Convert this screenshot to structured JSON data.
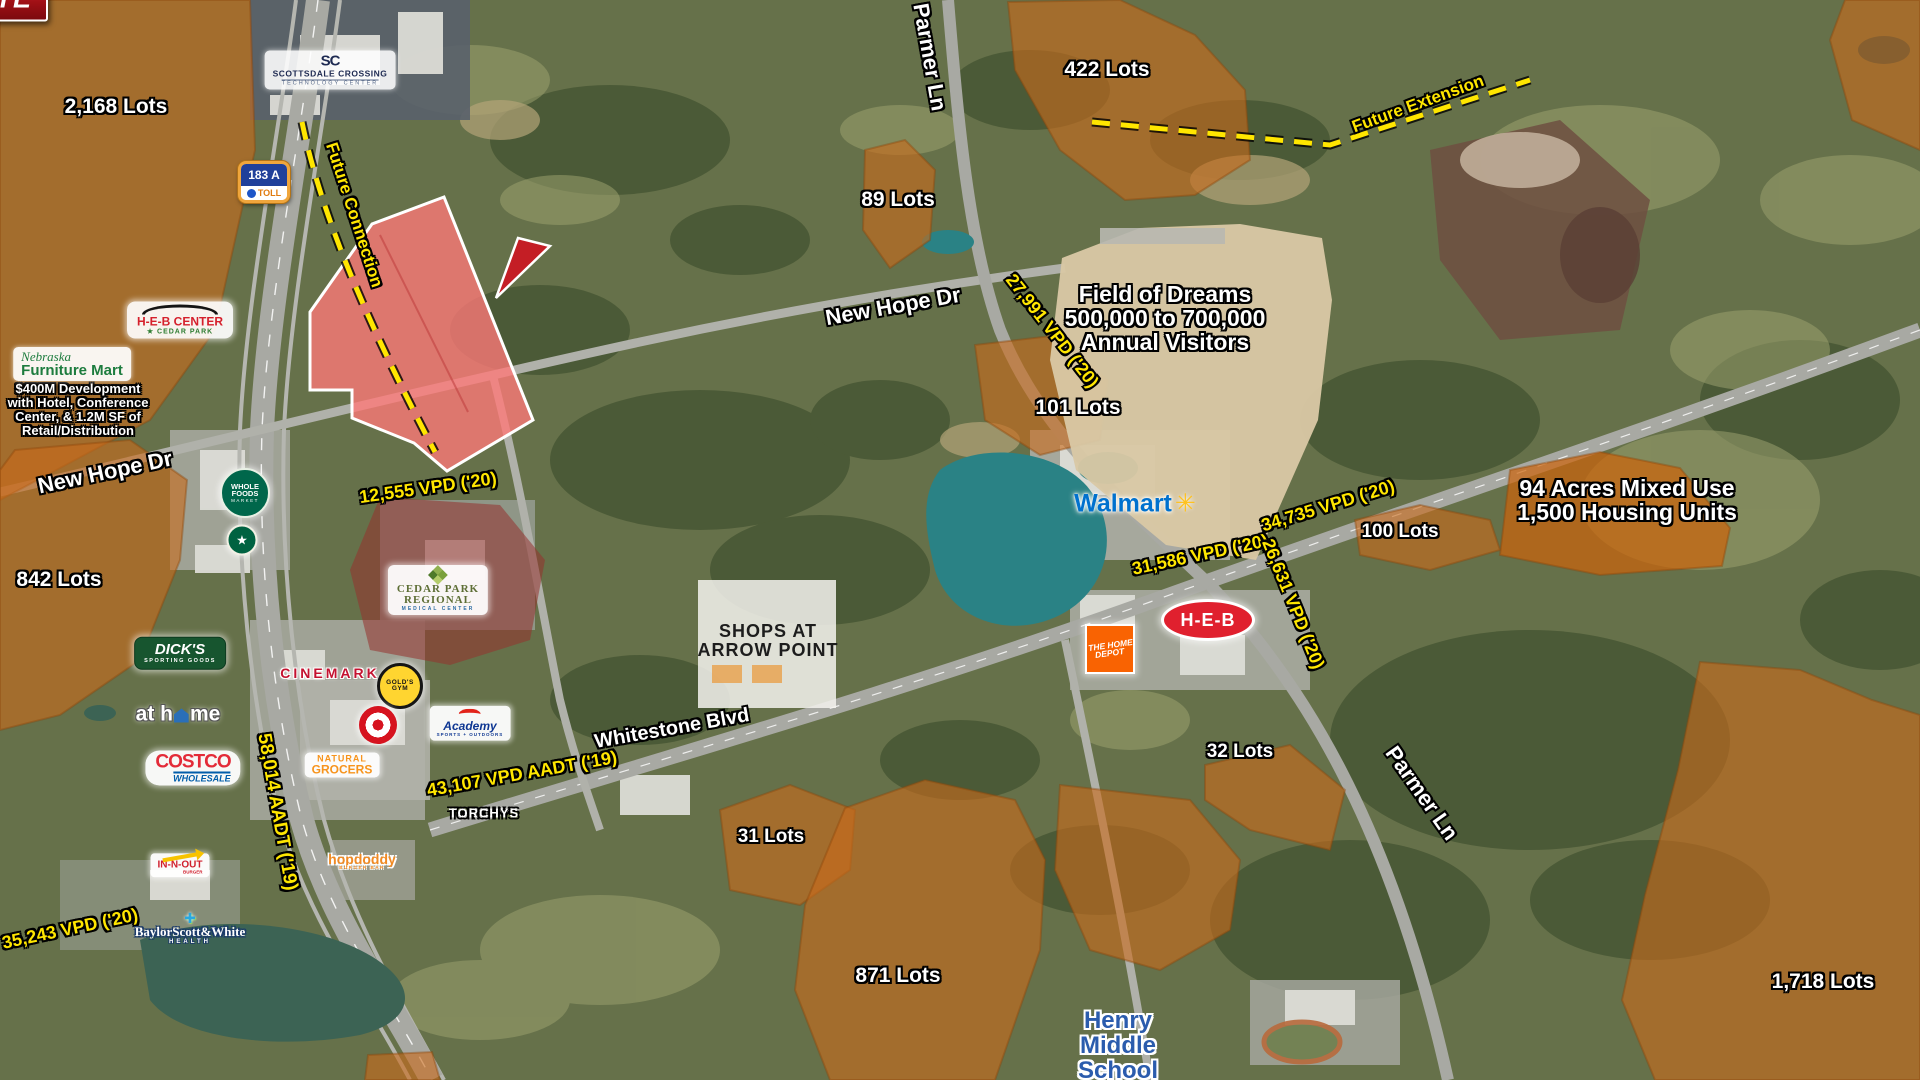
{
  "map": {
    "colors": {
      "residential_overlay": "#c86a1c",
      "site_parcel_fill": "#ff8a8a",
      "site_parcel_stroke": "#ffffff",
      "traffic_label_text": "#ffe600",
      "site_callout_red": "#c41e25",
      "school_label_blue": "#2b5cad",
      "water_teal": "#2a8285"
    },
    "site_callout": {
      "label": "SITE",
      "x": 555,
      "y": 222
    },
    "labels": [
      {
        "n": "lots-2168",
        "t": "2,168 Lots",
        "x": 116,
        "y": 107,
        "s": 21,
        "c": "lot"
      },
      {
        "n": "lots-422",
        "t": "422 Lots",
        "x": 1107,
        "y": 70,
        "s": 21,
        "c": "lot"
      },
      {
        "n": "lots-89",
        "t": "89 Lots",
        "x": 898,
        "y": 200,
        "s": 21,
        "c": "lot"
      },
      {
        "n": "lots-101",
        "t": "101 Lots",
        "x": 1078,
        "y": 408,
        "s": 21,
        "c": "lot"
      },
      {
        "n": "lots-842",
        "t": "842 Lots",
        "x": 59,
        "y": 580,
        "s": 21,
        "c": "lot"
      },
      {
        "n": "lots-100",
        "t": "100 Lots",
        "x": 1400,
        "y": 532,
        "s": 19,
        "c": "lot"
      },
      {
        "n": "lots-32",
        "t": "32 Lots",
        "x": 1240,
        "y": 752,
        "s": 19,
        "c": "lot"
      },
      {
        "n": "lots-31",
        "t": "31 Lots",
        "x": 771,
        "y": 837,
        "s": 19,
        "c": "lot"
      },
      {
        "n": "lots-871",
        "t": "871 Lots",
        "x": 898,
        "y": 976,
        "s": 21,
        "c": "lot"
      },
      {
        "n": "lots-1718",
        "t": "1,718 Lots",
        "x": 1823,
        "y": 982,
        "s": 21,
        "c": "lot"
      },
      {
        "n": "mixed-use-note",
        "lines": [
          "94 Acres Mixed Use",
          "1,500 Housing Units"
        ],
        "x": 1627,
        "y": 500,
        "s": 23,
        "c": "info"
      },
      {
        "n": "field-of-dreams-note",
        "lines": [
          "Field of Dreams",
          "500,000 to 700,000",
          "Annual Visitors"
        ],
        "x": 1165,
        "y": 318,
        "s": 23,
        "c": "info"
      },
      {
        "n": "henry-middle-school-label",
        "lines": [
          "Henry",
          "Middle",
          "School"
        ],
        "x": 1118,
        "y": 1046,
        "s": 24,
        "c": "school"
      },
      {
        "n": "nfm-development-note",
        "lines": [
          "$400M Development",
          "with Hotel, Conference",
          "Center, & 1.2M SF of",
          "Retail/Distribution"
        ],
        "x": 78,
        "y": 410,
        "s": 13,
        "c": "devnote"
      },
      {
        "n": "shops-arrow-point-label",
        "lines": [
          "SHOPS AT",
          "ARROW POINT"
        ],
        "x": 768,
        "y": 641,
        "s": 18,
        "c": "plan"
      },
      {
        "n": "road-new-hope-dr-west",
        "t": "New Hope Dr",
        "x": 105,
        "y": 472,
        "r": -12,
        "s": 22,
        "c": "road"
      },
      {
        "n": "road-new-hope-dr-east",
        "t": "New Hope Dr",
        "x": 893,
        "y": 306,
        "r": -10,
        "s": 22,
        "c": "road"
      },
      {
        "n": "road-whitestone-blvd",
        "t": "Whitestone Blvd",
        "x": 672,
        "y": 729,
        "r": -10,
        "s": 20,
        "c": "road"
      },
      {
        "n": "road-parmer-ln-north",
        "t": "Parmer Ln",
        "x": 930,
        "y": 57,
        "r": 80,
        "s": 22,
        "c": "road"
      },
      {
        "n": "road-parmer-ln-south",
        "t": "Parmer Ln",
        "x": 1422,
        "y": 793,
        "r": 55,
        "s": 22,
        "c": "road"
      },
      {
        "n": "traffic-12555",
        "t": "12,555 VPD ('20)",
        "x": 428,
        "y": 488,
        "r": -8,
        "s": 18,
        "c": "traffic"
      },
      {
        "n": "traffic-27991",
        "t": "27,991 VPD ('20)",
        "x": 1052,
        "y": 331,
        "r": 52,
        "s": 18,
        "c": "traffic"
      },
      {
        "n": "traffic-58014",
        "t": "58,014 AADT ('19)",
        "x": 277,
        "y": 812,
        "r": 80,
        "s": 19,
        "c": "traffic"
      },
      {
        "n": "traffic-35243",
        "t": "35,243 VPD ('20)",
        "x": 70,
        "y": 929,
        "r": -12,
        "s": 18,
        "c": "traffic"
      },
      {
        "n": "traffic-43107",
        "t": "43,107 VPD AADT ('19)",
        "x": 522,
        "y": 774,
        "r": -10,
        "s": 18,
        "c": "traffic"
      },
      {
        "n": "traffic-31586",
        "t": "31,586 VPD ('20)",
        "x": 1200,
        "y": 555,
        "r": -12,
        "s": 18,
        "c": "traffic"
      },
      {
        "n": "traffic-34735",
        "t": "34,735 VPD ('20)",
        "x": 1328,
        "y": 506,
        "r": -17,
        "s": 18,
        "c": "traffic"
      },
      {
        "n": "traffic-26631",
        "t": "26,631 VPD ('20)",
        "x": 1293,
        "y": 604,
        "r": 68,
        "s": 18,
        "c": "traffic"
      },
      {
        "n": "future-connection-label",
        "t": "Future Connection",
        "x": 354,
        "y": 215,
        "r": 72,
        "s": 17,
        "c": "future"
      },
      {
        "n": "future-extension-label",
        "t": "Future Extension",
        "x": 1418,
        "y": 104,
        "r": -20,
        "s": 17,
        "c": "future"
      }
    ],
    "logos": [
      {
        "brand": "scottsdale",
        "x": 330,
        "y": 70,
        "parts": [
          {
            "c": "sc-mono",
            "t": "SC"
          },
          {
            "c": "sc-l1",
            "t": "SCOTTSDALE CROSSING"
          },
          {
            "c": "sc-l2",
            "t": "TECHNOLOGY CENTER"
          }
        ]
      },
      {
        "brand": "heb-center",
        "x": 180,
        "y": 320,
        "parts": [
          {
            "c": "roof"
          },
          {
            "c": "hc1",
            "t": "H-E-B CENTER"
          },
          {
            "c": "hc2",
            "t": "★ CEDAR PARK"
          }
        ]
      },
      {
        "brand": "nfm",
        "x": 72,
        "y": 364,
        "parts": [
          {
            "c": "nfm1",
            "t": "Nebraska"
          },
          {
            "c": "nfm2",
            "t": "Furniture Mart"
          }
        ]
      },
      {
        "brand": "wholefoods",
        "x": 245,
        "y": 493,
        "parts": [
          {
            "c": "wf1",
            "t": "WHOLE"
          },
          {
            "c": "wf1",
            "t": "FOODS"
          },
          {
            "c": "wf2",
            "t": "MARKET"
          }
        ]
      },
      {
        "brand": "starbucks",
        "x": 242,
        "y": 540,
        "parts": [
          {
            "c": "sb",
            "t": "★"
          }
        ]
      },
      {
        "brand": "dicks",
        "x": 180,
        "y": 653,
        "parts": [
          {
            "c": "dk1",
            "t": "DICK'S"
          },
          {
            "c": "dk2",
            "t": "SPORTING GOODS"
          }
        ]
      },
      {
        "brand": "athome",
        "x": 178,
        "y": 714,
        "parts": [
          {
            "c": "ah-t",
            "t": "at h"
          },
          {
            "c": "ah-house"
          },
          {
            "c": "ah-t",
            "t": "me"
          }
        ]
      },
      {
        "brand": "costco",
        "x": 193,
        "y": 768,
        "parts": [
          {
            "c": "co1",
            "t": "COSTCO"
          },
          {
            "c": "co2",
            "t": "WHOLESALE"
          }
        ]
      },
      {
        "brand": "cinemark",
        "x": 330,
        "y": 673,
        "parts": [
          {
            "c": "cm",
            "t": "CINEMARK"
          }
        ]
      },
      {
        "brand": "golds",
        "x": 400,
        "y": 686,
        "parts": [
          {
            "c": "gg",
            "t": "GOLD'S"
          },
          {
            "c": "gg",
            "t": "GYM"
          }
        ]
      },
      {
        "brand": "target",
        "x": 378,
        "y": 725,
        "parts": [
          {
            "c": "tg-bull"
          }
        ]
      },
      {
        "brand": "academy",
        "x": 470,
        "y": 723,
        "parts": [
          {
            "c": "ac-arc"
          },
          {
            "c": "ac1",
            "t": "Academy"
          },
          {
            "c": "ac2",
            "t": "SPORTS + OUTDOORS"
          }
        ]
      },
      {
        "brand": "naturalgrocers",
        "x": 342,
        "y": 765,
        "parts": [
          {
            "c": "ng1",
            "t": "NATURAL"
          },
          {
            "c": "ng2",
            "t": "GROCERS"
          }
        ]
      },
      {
        "brand": "torchys",
        "x": 484,
        "y": 813,
        "parts": [
          {
            "c": "tor",
            "t": "TORCHYS"
          }
        ]
      },
      {
        "brand": "innout",
        "x": 180,
        "y": 865,
        "parts": [
          {
            "c": "io-arrow"
          },
          {
            "c": "io1",
            "t": "IN-N-OUT"
          },
          {
            "c": "io2",
            "t": "BURGER"
          }
        ]
      },
      {
        "brand": "baylor",
        "x": 190,
        "y": 928,
        "parts": [
          {
            "c": "by-cross",
            "t": "✚"
          },
          {
            "c": "by1",
            "t": "BaylorScott&White"
          },
          {
            "c": "by2",
            "t": "HEALTH"
          }
        ]
      },
      {
        "brand": "hopdoddy",
        "x": 362,
        "y": 861,
        "parts": [
          {
            "c": "hd1",
            "t": "hopdoddy"
          },
          {
            "c": "hd2",
            "t": "BURGER BAR"
          }
        ]
      },
      {
        "brand": "cedarpark",
        "x": 438,
        "y": 590,
        "parts": [
          {
            "c": "cp-icon"
          },
          {
            "c": "cp1",
            "t": "CEDAR PARK"
          },
          {
            "c": "cp2",
            "t": "REGIONAL"
          },
          {
            "c": "cp3",
            "t": "MEDICAL CENTER"
          }
        ]
      },
      {
        "brand": "walmart",
        "x": 1135,
        "y": 504,
        "parts": [
          {
            "c": "wm1",
            "t": "Walmart"
          },
          {
            "c": "wm-spark",
            "t": "✳"
          }
        ]
      },
      {
        "brand": "hebstore",
        "x": 1208,
        "y": 620,
        "parts": [
          {
            "c": "heb",
            "t": "H-E-B"
          }
        ]
      },
      {
        "brand": "homedepot",
        "x": 1110,
        "y": 649,
        "parts": [
          {
            "c": "hdp1",
            "t": "THE HOME"
          },
          {
            "c": "hdp2",
            "t": "DEPOT"
          }
        ]
      }
    ],
    "shields": [
      {
        "k": "toll",
        "x": 264,
        "y": 182,
        "num": "183 A",
        "sub": "TOLL"
      },
      {
        "k": "toll",
        "x": 320,
        "y": 1015,
        "num": "183 A",
        "sub": "TOLL"
      },
      {
        "k": "fm",
        "x": 236,
        "y": 867,
        "num": "1431",
        "top": "FARM",
        "bottom": "ROAD"
      },
      {
        "k": "fm",
        "x": 905,
        "y": 665,
        "num": "1431",
        "top": "FARM",
        "bottom": "ROAD"
      },
      {
        "k": "fm",
        "x": 1820,
        "y": 276,
        "num": "1431",
        "top": "FARM",
        "bottom": "ROAD"
      }
    ],
    "field_of_dreams": {
      "fields": [
        {
          "t": "B",
          "x": 1177,
          "y": 238
        },
        {
          "t": "A1",
          "x": 1145,
          "y": 247
        },
        {
          "t": "A9",
          "x": 1207,
          "y": 247
        },
        {
          "t": "A2",
          "x": 1105,
          "y": 260
        },
        {
          "t": "D",
          "x": 1157,
          "y": 272,
          "red": true
        },
        {
          "t": "A13",
          "x": 1248,
          "y": 252
        },
        {
          "t": "A15",
          "x": 1283,
          "y": 263
        },
        {
          "t": "A18",
          "x": 1262,
          "y": 279
        },
        {
          "t": "A16",
          "x": 1270,
          "y": 301
        },
        {
          "t": "A10",
          "x": 1238,
          "y": 289
        },
        {
          "t": "A7",
          "x": 1232,
          "y": 322
        },
        {
          "t": "A6",
          "x": 1178,
          "y": 360
        },
        {
          "t": "A8",
          "x": 1213,
          "y": 386
        },
        {
          "t": "E",
          "x": 1075,
          "y": 276,
          "ground": true
        },
        {
          "t": "E",
          "x": 1072,
          "y": 318,
          "ground": true
        },
        {
          "t": "E",
          "x": 1157,
          "y": 381,
          "ground": true
        }
      ]
    }
  }
}
